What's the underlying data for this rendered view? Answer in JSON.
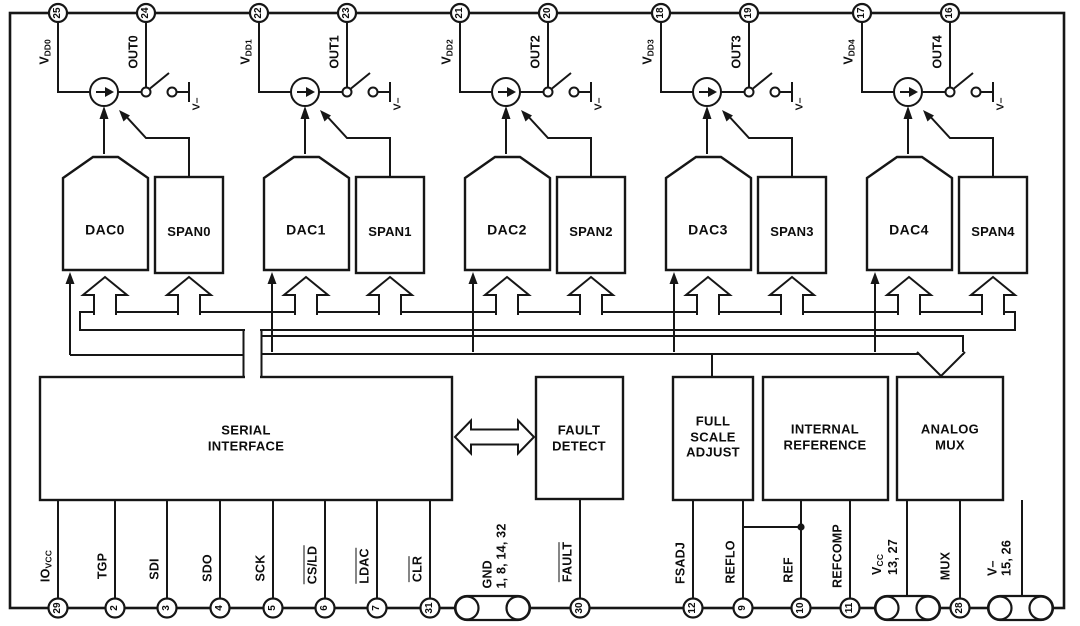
{
  "channels": [
    {
      "vdd_num": "25",
      "vdd_main": "V",
      "vdd_sub": "DD0",
      "out_num": "24",
      "out_label": "OUT0",
      "dac": "DAC0",
      "span": "SPAN0",
      "vminus": "V–"
    },
    {
      "vdd_num": "22",
      "vdd_main": "V",
      "vdd_sub": "DD1",
      "out_num": "23",
      "out_label": "OUT1",
      "dac": "DAC1",
      "span": "SPAN1",
      "vminus": "V–"
    },
    {
      "vdd_num": "21",
      "vdd_main": "V",
      "vdd_sub": "DD2",
      "out_num": "20",
      "out_label": "OUT2",
      "dac": "DAC2",
      "span": "SPAN2",
      "vminus": "V–"
    },
    {
      "vdd_num": "18",
      "vdd_main": "V",
      "vdd_sub": "DD3",
      "out_num": "19",
      "out_label": "OUT3",
      "dac": "DAC3",
      "span": "SPAN3",
      "vminus": "V–"
    },
    {
      "vdd_num": "17",
      "vdd_main": "V",
      "vdd_sub": "DD4",
      "out_num": "16",
      "out_label": "OUT4",
      "dac": "DAC4",
      "span": "SPAN4",
      "vminus": "V–"
    }
  ],
  "blocks": {
    "serial": "SERIAL\nINTERFACE",
    "fault": "FAULT\nDETECT",
    "fsa": "FULL\nSCALE\nADJUST",
    "intref": "INTERNAL\nREFERENCE",
    "mux": "ANALOG\nMUX"
  },
  "bottom": {
    "iovcc": {
      "num": "29",
      "main": "IO",
      "sub": "VCC"
    },
    "tgp": {
      "num": "2",
      "label": "TGP"
    },
    "sdi": {
      "num": "3",
      "label": "SDI"
    },
    "sdo": {
      "num": "4",
      "label": "SDO"
    },
    "sck": {
      "num": "5",
      "label": "SCK"
    },
    "csld": {
      "num": "6",
      "label": "CS/LD"
    },
    "ldac": {
      "num": "7",
      "label": "LDAC"
    },
    "clr": {
      "num": "31",
      "label": "CLR"
    },
    "gnd": {
      "label": "GND",
      "pins": "1, 8, 14, 32"
    },
    "fault": {
      "num": "30",
      "label": "FAULT"
    },
    "fsadj": {
      "num": "12",
      "label": "FSADJ"
    },
    "reflo": {
      "num": "9",
      "label": "REFLO"
    },
    "ref": {
      "num": "10",
      "label": "REF"
    },
    "refcomp": {
      "num": "11",
      "label": "REFCOMP"
    },
    "vcc": {
      "main": "V",
      "sub": "CC",
      "pins": "13, 27"
    },
    "mux": {
      "num": "28",
      "label": "MUX"
    },
    "vminus": {
      "label": "V–",
      "pins": "15, 26"
    }
  }
}
